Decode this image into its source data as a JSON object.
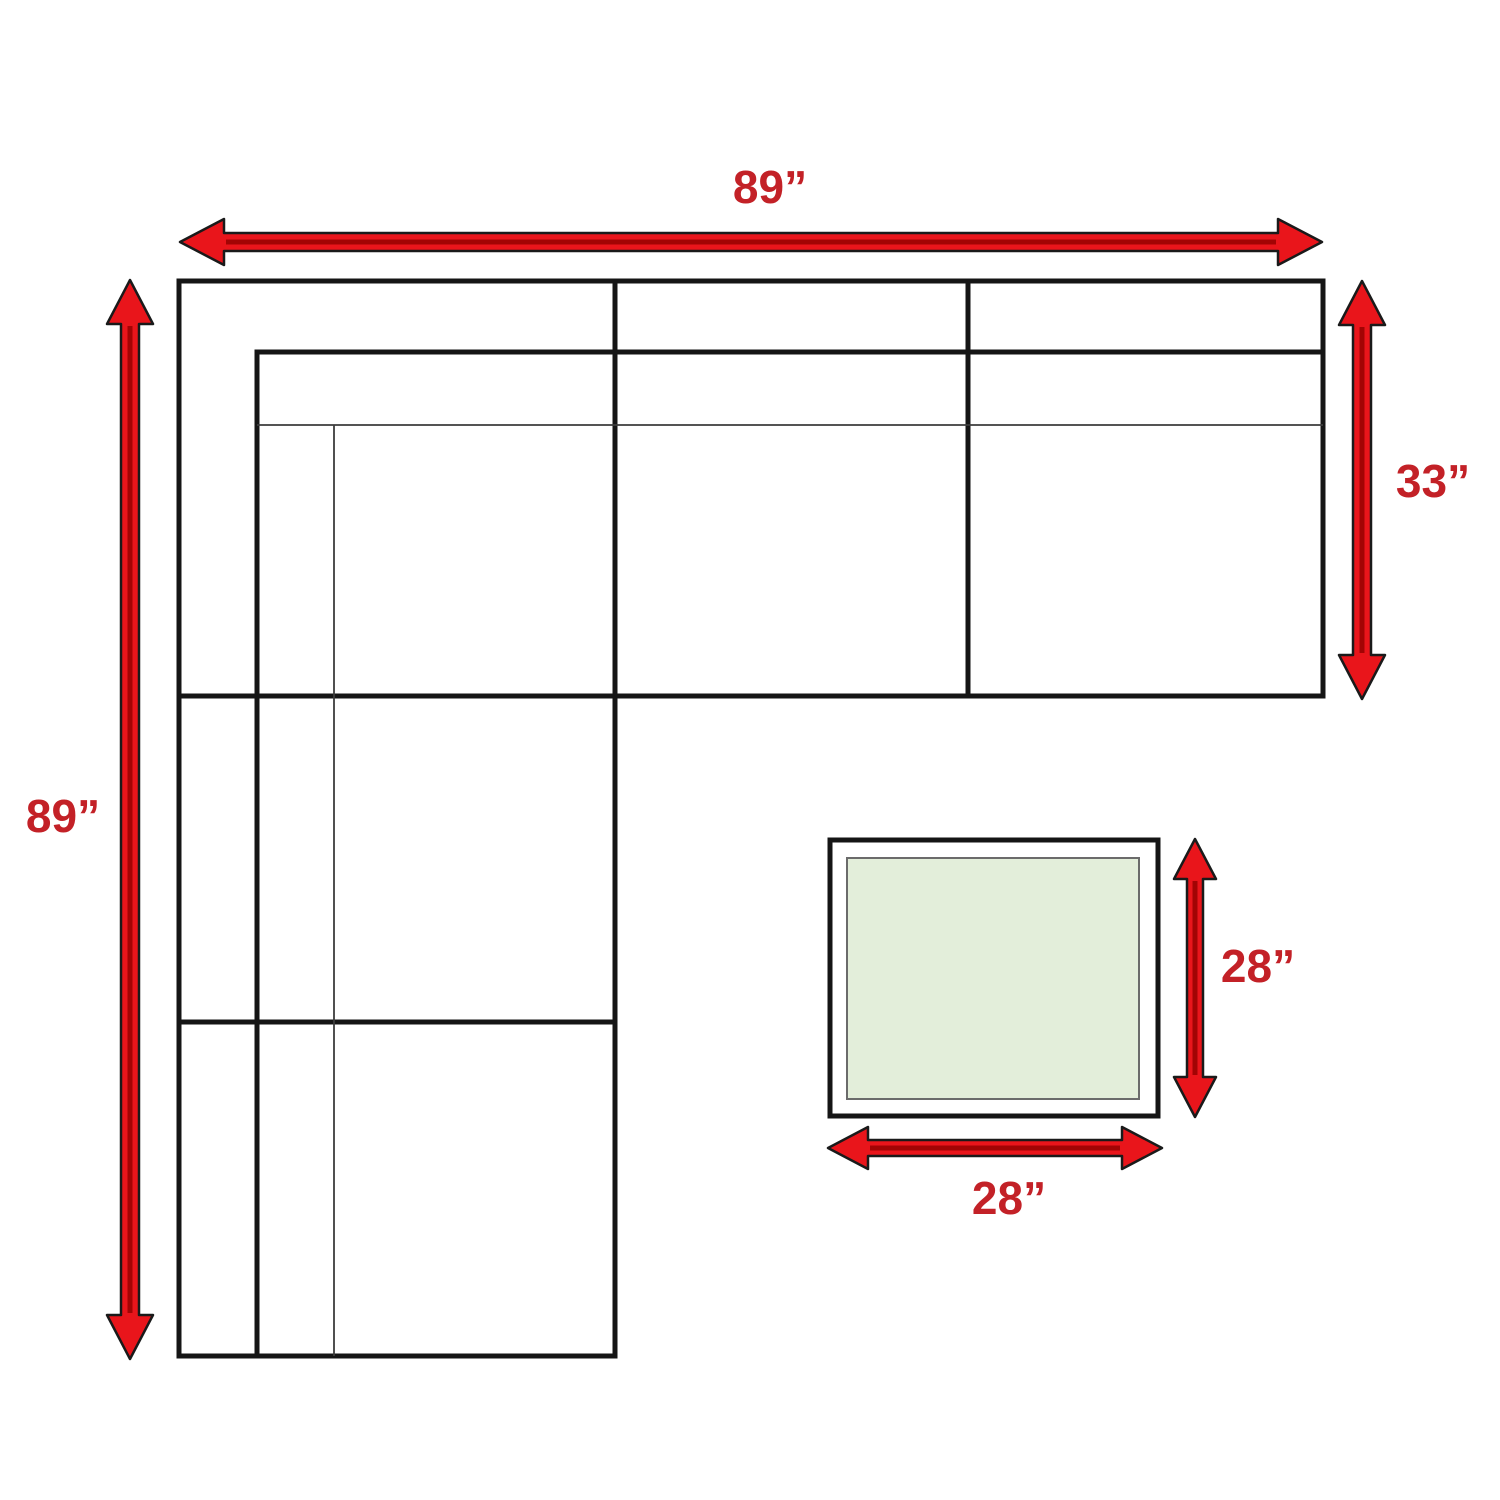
{
  "labels": {
    "sofa_width": "89”",
    "sofa_depth": "89”",
    "section_depth": "33”",
    "ottoman_depth": "28”",
    "ottoman_width": "28”"
  },
  "colors": {
    "arrow_fill": "#e9151b",
    "arrow_outline": "#1a1a1a",
    "label_text": "#c32127",
    "sofa_outline": "#151515",
    "ottoman_fill": "#e3eeda",
    "background": "#ffffff"
  }
}
